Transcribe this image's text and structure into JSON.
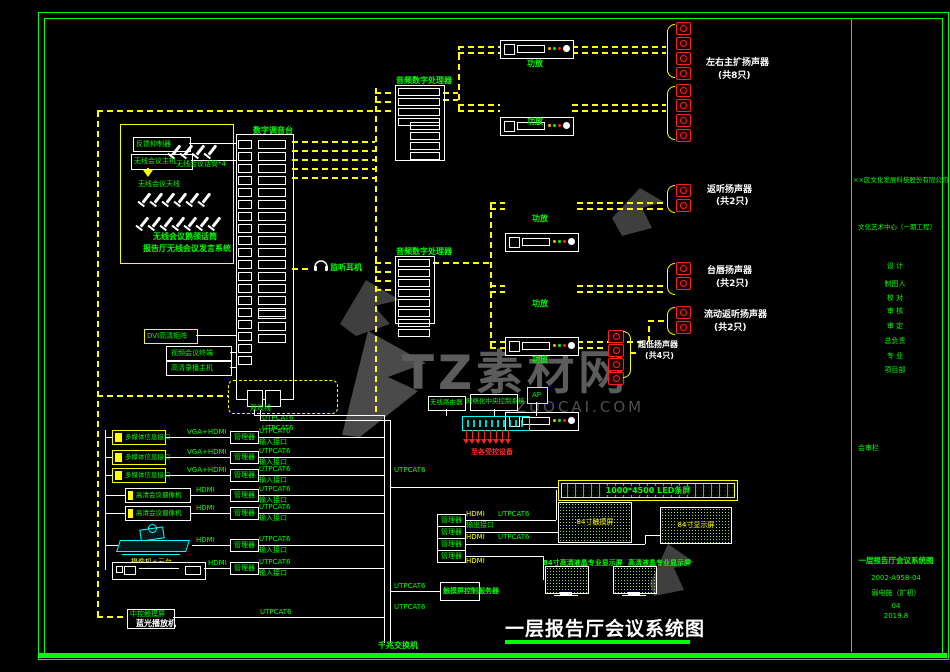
{
  "colors": {
    "accent_green": "#00ff00",
    "accent_yellow": "#ffff00",
    "speaker_red": "#ff2020",
    "device_cyan": "#00ffff",
    "watermark_gray": "#5c5c5c"
  },
  "watermark": {
    "brand": "TZ素材网",
    "site": "TUZUOCAI.COM"
  },
  "main_title": "一层报告厅会议系统图",
  "wireless": {
    "feedback": "反馈抑制器",
    "host": "无线会议主机",
    "mics": "无线会议话筒*4",
    "antenna": "无线会议天线",
    "caption1": "无线会议鹅颈话筒",
    "caption2": "报告厅无线会议发言系统"
  },
  "mixer": {
    "label": "数字调音台",
    "monitor": "监听耳机"
  },
  "dsp": {
    "label": "音频数字处理器"
  },
  "amp": {
    "label": "功放"
  },
  "speakers": {
    "main": {
      "name": "左右主扩扬声器",
      "qty": "(共8只)"
    },
    "foldback": {
      "name": "返听扬声器",
      "qty": "(共2只)"
    },
    "lip": {
      "name": "台唇扬声器",
      "qty": "(共2只)"
    },
    "mobile": {
      "name": "流动返听扬声器",
      "qty": "(共2只)"
    },
    "sub": {
      "name": "超低扬声器",
      "qty": "(共4只)"
    }
  },
  "av": {
    "matrix": "DVI高清矩阵",
    "vc": "视频会议终端",
    "recorder": "高清录播主机",
    "twisted_pair": "双绞线",
    "utp": "UTPCAT6"
  },
  "inputs": {
    "node": "管理器",
    "cable": "UTPCAT6",
    "port": "输入接口",
    "rows": [
      {
        "device": "多媒体信息接口",
        "signal": "VGA+HDMI"
      },
      {
        "device": "多媒体信息接口",
        "signal": "VGA+HDMI"
      },
      {
        "device": "多媒体信息接口",
        "signal": "VGA+HDMI"
      },
      {
        "device": "高清会议摄像机",
        "signal": "HDMI"
      },
      {
        "device": "高清会议摄像机",
        "signal": "HDMI"
      },
      {
        "device": "摄像机+云台",
        "signal": "HDMI"
      },
      {
        "device": "蓝光播放机",
        "signal": "HDMI"
      }
    ],
    "panel": {
      "green_label": "中控触摸屏"
    }
  },
  "outputs": {
    "node": "管理器",
    "hdmi": "HDMI",
    "cable": "UTPCAT6",
    "port": "输出接口"
  },
  "control": {
    "router": "无线路由器",
    "host": "网络化中央控制系统",
    "ap": "AP",
    "to_devices": "至各受控设备",
    "server": "触摸屏控制服务器",
    "switch": "千兆交换机"
  },
  "displays": {
    "led": "1000*4500 LED条屏",
    "left84": "84寸触摸屏",
    "right84": "84寸显示屏",
    "label_left": "84寸高清液晶专业显示屏",
    "label_right": "高清液晶专业显示屏"
  },
  "title_block": {
    "company": "××区文化发展科技股份有限公司",
    "project": "文化艺术中心（一期工程）",
    "fields": [
      "设 计",
      "制图人",
      "校 对",
      "审 核",
      "审 定",
      "总负责",
      "专 业",
      "项目部"
    ],
    "review": "会审栏",
    "drawing_name": "一层报告厅会议系统图",
    "drawing_no": "2002-A958-04",
    "stage": "弱电施（扩初）",
    "sheet": "04",
    "date": "2019.8"
  }
}
